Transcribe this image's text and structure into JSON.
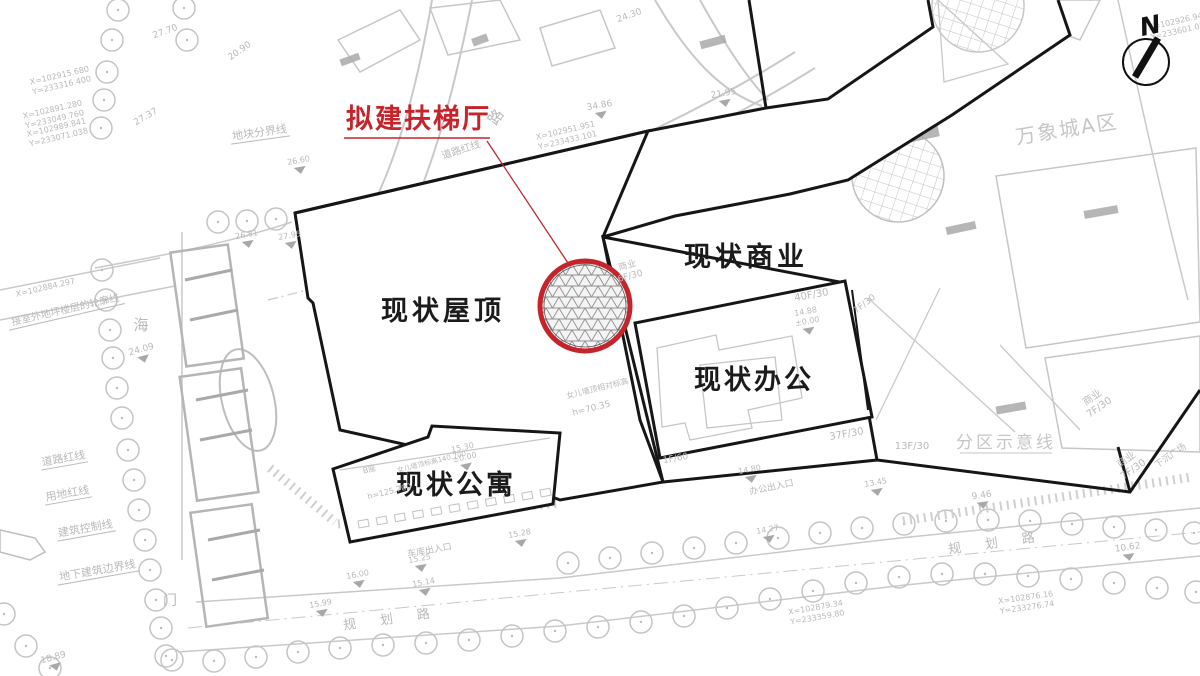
{
  "colors": {
    "accent_red": "#c5242b",
    "line_black": "#161616",
    "gray_line": "#c9c9c9",
    "gray_text": "#b9b9b9"
  },
  "proposed": {
    "label": "拟建扶梯厅"
  },
  "buildings": {
    "roof_label": "现状屋顶",
    "commercial_label": "现状商业",
    "office_label": "现状办公",
    "apartment_label": "现状公寓"
  },
  "district": {
    "mixc_label": "万象城A区",
    "zoning_label": "分区示意线"
  },
  "compass": {
    "north_label": "N"
  },
  "map_labels": [
    {
      "t": "道路红线",
      "x": 462,
      "y": 153,
      "r": -18,
      "s": 10
    },
    {
      "t": "道路红线",
      "x": 64,
      "y": 462,
      "r": -10,
      "s": 11,
      "u": 1
    },
    {
      "t": "用地红线",
      "x": 68,
      "y": 497,
      "r": -10,
      "s": 11,
      "u": 1
    },
    {
      "t": "建筑控制线",
      "x": 86,
      "y": 532,
      "r": -10,
      "s": 11,
      "u": 1
    },
    {
      "t": "地下建筑边界线",
      "x": 98,
      "y": 574,
      "r": -10,
      "s": 11,
      "u": 1
    },
    {
      "t": "接室外地坪楼层的轮廓线",
      "x": 66,
      "y": 313,
      "r": -13,
      "s": 10,
      "u": 1
    },
    {
      "t": "地块分界线",
      "x": 260,
      "y": 136,
      "r": -8,
      "s": 11,
      "u": 1
    },
    {
      "t": "海",
      "x": 141,
      "y": 330,
      "r": 0,
      "s": 15
    },
    {
      "t": "路",
      "x": 500,
      "y": 120,
      "r": -55,
      "s": 15
    },
    {
      "t": "门",
      "x": 170,
      "y": 605,
      "r": 0,
      "s": 14
    },
    {
      "t": "规 划 路",
      "x": 392,
      "y": 623,
      "r": -8,
      "s": 13,
      "ls": 10
    },
    {
      "t": "规 划 路",
      "x": 997,
      "y": 547,
      "r": -8,
      "s": 13,
      "ls": 10
    },
    {
      "lines": [
        "商业",
        "6F/30"
      ],
      "x": 628,
      "y": 268,
      "r": -15,
      "s": 9
    },
    {
      "t": "40F/30",
      "x": 812,
      "y": 298,
      "r": -10,
      "s": 10
    },
    {
      "lines": [
        "14.88",
        "±0.00"
      ],
      "x": 806,
      "y": 314,
      "r": -10,
      "s": 8,
      "f": 1
    },
    {
      "t": "7F/30",
      "x": 866,
      "y": 306,
      "r": -38,
      "s": 9
    },
    {
      "t": "37F/30",
      "x": 847,
      "y": 437,
      "r": -10,
      "s": 10
    },
    {
      "t": "13F/30",
      "x": 912,
      "y": 449,
      "r": 0,
      "s": 10
    },
    {
      "t": "1F/60",
      "x": 676,
      "y": 461,
      "r": -10,
      "s": 9
    },
    {
      "lines": [
        "商业",
        "7F/30"
      ],
      "x": 1094,
      "y": 400,
      "r": -35,
      "s": 10
    },
    {
      "lines": [
        "商业",
        "7F/30"
      ],
      "x": 1128,
      "y": 462,
      "r": -35,
      "s": 10
    },
    {
      "t": "下沉广场",
      "x": 1172,
      "y": 458,
      "r": -35,
      "s": 9
    },
    {
      "t": "办公出入口",
      "x": 772,
      "y": 490,
      "r": -12,
      "s": 9
    },
    {
      "t": "车库出入口",
      "x": 430,
      "y": 553,
      "r": -10,
      "s": 9
    },
    {
      "t": "B座",
      "x": 370,
      "y": 472,
      "r": -14,
      "s": 8
    },
    {
      "t": "女儿墙顶标高140.700",
      "x": 432,
      "y": 464,
      "r": -14,
      "s": 7
    },
    {
      "t": "h=125.700",
      "x": 390,
      "y": 494,
      "r": -14,
      "s": 8
    },
    {
      "t": "女儿墙顶相对标高",
      "x": 598,
      "y": 391,
      "r": -14,
      "s": 8
    },
    {
      "t": "h=70.35",
      "x": 592,
      "y": 411,
      "r": -14,
      "s": 9
    },
    {
      "lines": [
        "X=102951.951",
        "Y=233433.101"
      ],
      "x": 566,
      "y": 133,
      "r": -13,
      "s": 8
    },
    {
      "lines": [
        "X=102915.680",
        "Y=233316.400"
      ],
      "x": 60,
      "y": 78,
      "r": -13,
      "s": 8
    },
    {
      "lines": [
        "X=102891.280",
        "Y=233049.760"
      ],
      "x": 53,
      "y": 112,
      "r": -13,
      "s": 8
    },
    {
      "lines": [
        "X=102989.841",
        "Y=233071.038"
      ],
      "x": 57,
      "y": 130,
      "r": -13,
      "s": 8
    },
    {
      "t": "X=102884.297",
      "x": 46,
      "y": 290,
      "r": -13,
      "s": 8
    },
    {
      "lines": [
        "X=102879.34",
        "Y=233359.80"
      ],
      "x": 816,
      "y": 610,
      "r": -10,
      "s": 8
    },
    {
      "lines": [
        "X=102876.16",
        "Y=233276.74"
      ],
      "x": 1026,
      "y": 600,
      "r": -8,
      "s": 8
    },
    {
      "lines": [
        "X=102926.94",
        "Y=233601.05"
      ],
      "x": 1176,
      "y": 24,
      "r": -13,
      "s": 8
    },
    {
      "t": "34.86",
      "x": 600,
      "y": 108,
      "r": -10,
      "s": 9,
      "f": 1
    },
    {
      "t": "21.95",
      "x": 724,
      "y": 96,
      "r": -10,
      "s": 9,
      "f": 1
    },
    {
      "t": "24.30",
      "x": 630,
      "y": 18,
      "r": -20,
      "s": 9
    },
    {
      "t": "20.90",
      "x": 241,
      "y": 53,
      "r": -35,
      "s": 9
    },
    {
      "t": "27.70",
      "x": 166,
      "y": 34,
      "r": -20,
      "s": 9
    },
    {
      "t": "27.37",
      "x": 147,
      "y": 119,
      "r": -30,
      "s": 9
    },
    {
      "t": "24.09",
      "x": 142,
      "y": 352,
      "r": -15,
      "s": 9,
      "f": 1
    },
    {
      "t": "26.81",
      "x": 247,
      "y": 237,
      "r": -10,
      "s": 8,
      "f": 1
    },
    {
      "t": "27.95",
      "x": 290,
      "y": 238,
      "r": -10,
      "s": 8,
      "f": 1
    },
    {
      "t": "26.60",
      "x": 299,
      "y": 163,
      "r": -10,
      "s": 8,
      "f": 1
    },
    {
      "lines": [
        "15.30",
        "±0.00"
      ],
      "x": 463,
      "y": 450,
      "r": -12,
      "s": 8,
      "f": 1
    },
    {
      "t": "14.80",
      "x": 750,
      "y": 472,
      "r": -10,
      "s": 8,
      "f": 1
    },
    {
      "t": "14.27",
      "x": 768,
      "y": 532,
      "r": -10,
      "s": 8,
      "f": 1
    },
    {
      "t": "15.25",
      "x": 420,
      "y": 561,
      "r": -10,
      "s": 8,
      "f": 1
    },
    {
      "t": "15.14",
      "x": 424,
      "y": 585,
      "r": -10,
      "s": 8,
      "f": 1
    },
    {
      "t": "16.00",
      "x": 358,
      "y": 577,
      "r": -10,
      "s": 8,
      "f": 1
    },
    {
      "t": "15.99",
      "x": 321,
      "y": 606,
      "r": -10,
      "s": 8,
      "f": 1
    },
    {
      "t": "15.28",
      "x": 520,
      "y": 536,
      "r": -10,
      "s": 8,
      "f": 1
    },
    {
      "t": "18.89",
      "x": 54,
      "y": 660,
      "r": -15,
      "s": 9,
      "f": 1
    },
    {
      "t": "9.46",
      "x": 982,
      "y": 498,
      "r": -8,
      "s": 9,
      "f": 1
    },
    {
      "t": "10.62",
      "x": 1128,
      "y": 550,
      "r": -8,
      "s": 9,
      "f": 1
    },
    {
      "t": "13.45",
      "x": 876,
      "y": 485,
      "r": -10,
      "s": 8,
      "f": 1
    }
  ]
}
